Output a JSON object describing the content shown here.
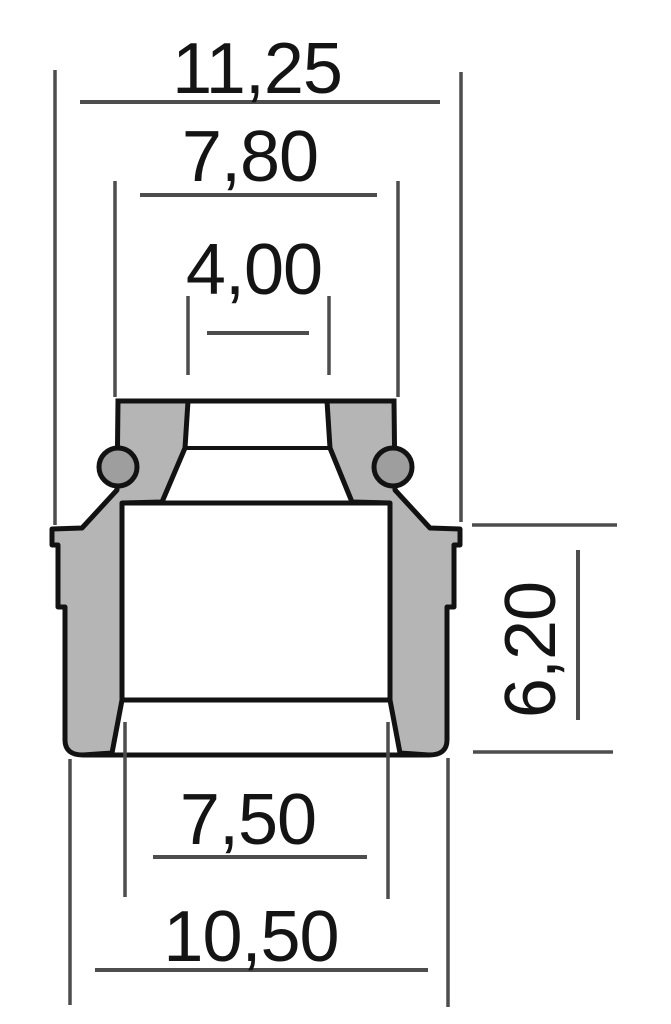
{
  "diagram": {
    "kind": "technical cross-section drawing with dimensions",
    "dimensions": [
      {
        "name": "flange-outer-diameter",
        "label": "11,25"
      },
      {
        "name": "top-outer-diameter",
        "label": "7,80"
      },
      {
        "name": "stem-bore-diameter",
        "label": "4,00"
      },
      {
        "name": "body-height",
        "label": "6,20"
      },
      {
        "name": "lower-bore-diameter",
        "label": "7,50"
      },
      {
        "name": "body-outer-diameter",
        "label": "10,50"
      }
    ],
    "colors": {
      "background": "#ffffff",
      "outline": "#121212",
      "body_fill": "#b5b5b5",
      "spring_fill": "#9e9e9e",
      "dimension_line": "#4d4d4d",
      "label_text": "#141414"
    }
  }
}
